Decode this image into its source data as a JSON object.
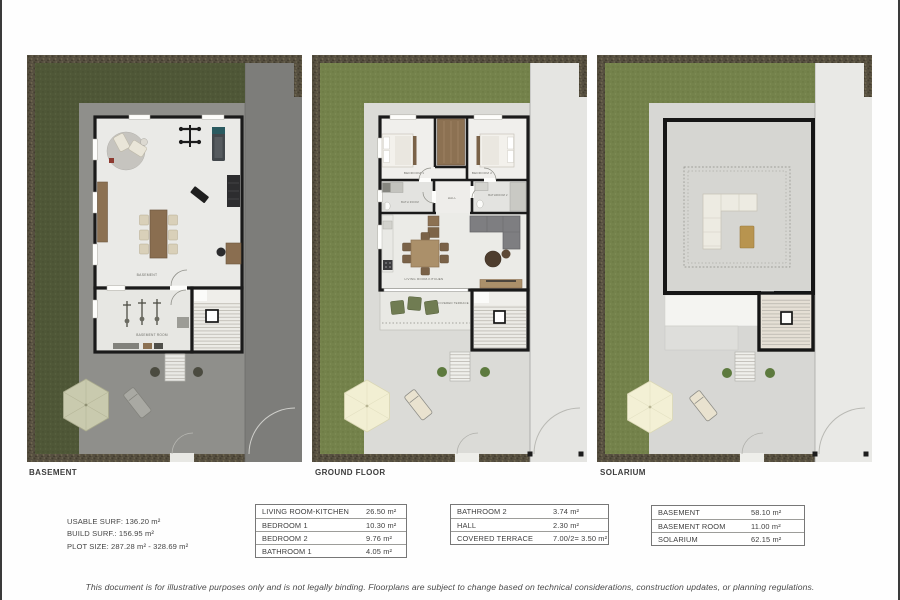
{
  "page": {
    "disclaimer": "This document is for illustrative purposes only and is not legally binding. Floorplans are subject to change based on technical considerations, construction updates, or planning regulations."
  },
  "plans": {
    "basement": {
      "title": "BASEMENT",
      "labels": {
        "main": "BASEMENT",
        "room": "BASEMENT ROOM"
      }
    },
    "ground": {
      "title": "GROUND FLOOR",
      "labels": {
        "bedroom1": "BEDROOM 1",
        "bedroom2": "BEDROOM 2",
        "bathroom1": "BATH ROOM",
        "hall": "HALL",
        "bathroom2": "BATHROOM 2",
        "living": "LIVING ROOM-KITCHEN",
        "terrace": "COVERED TERRACE"
      }
    },
    "solarium": {
      "title": "SOLARIUM"
    }
  },
  "summary": {
    "lines": [
      "USABLE SURF: 136.20 m²",
      "BUILD SURF.: 156.95 m²",
      "PLOT SIZE: 287.28 m² - 328.69 m²"
    ]
  },
  "tables": {
    "t1": {
      "rows": [
        {
          "label": "LIVING ROOM-KITCHEN",
          "value": "26.50 m²"
        },
        {
          "label": "BEDROOM 1",
          "value": "10.30 m²"
        },
        {
          "label": "BEDROOM 2",
          "value": "9.76 m²"
        },
        {
          "label": "BATHROOM 1",
          "value": "4.05 m²"
        }
      ]
    },
    "t2": {
      "rows": [
        {
          "label": "BATHROOM 2",
          "value": "3.74 m²"
        },
        {
          "label": "HALL",
          "value": "2.30 m²"
        },
        {
          "label": "COVERED TERRACE",
          "value": "7.00/2= 3.50 m²"
        }
      ]
    },
    "t3": {
      "rows": [
        {
          "label": "BASEMENT",
          "value": "58.10 m²"
        },
        {
          "label": "BASEMENT ROOM",
          "value": "11.00 m²"
        },
        {
          "label": "SOLARIUM",
          "value": "62.15 m²"
        }
      ]
    }
  },
  "colors": {
    "mulch": "#564f40",
    "grass_dark": "#4f5737",
    "grass_light": "#74824b",
    "paving_dark": "#8f8f8b",
    "paving_light": "#dbdbd7",
    "wall": "#1a1a1a",
    "wood": "#8c7152",
    "sofa_gray": "#7e7e81",
    "umbrella_cream": "#f2efd3",
    "umbrella_olive": "#c9caae"
  }
}
